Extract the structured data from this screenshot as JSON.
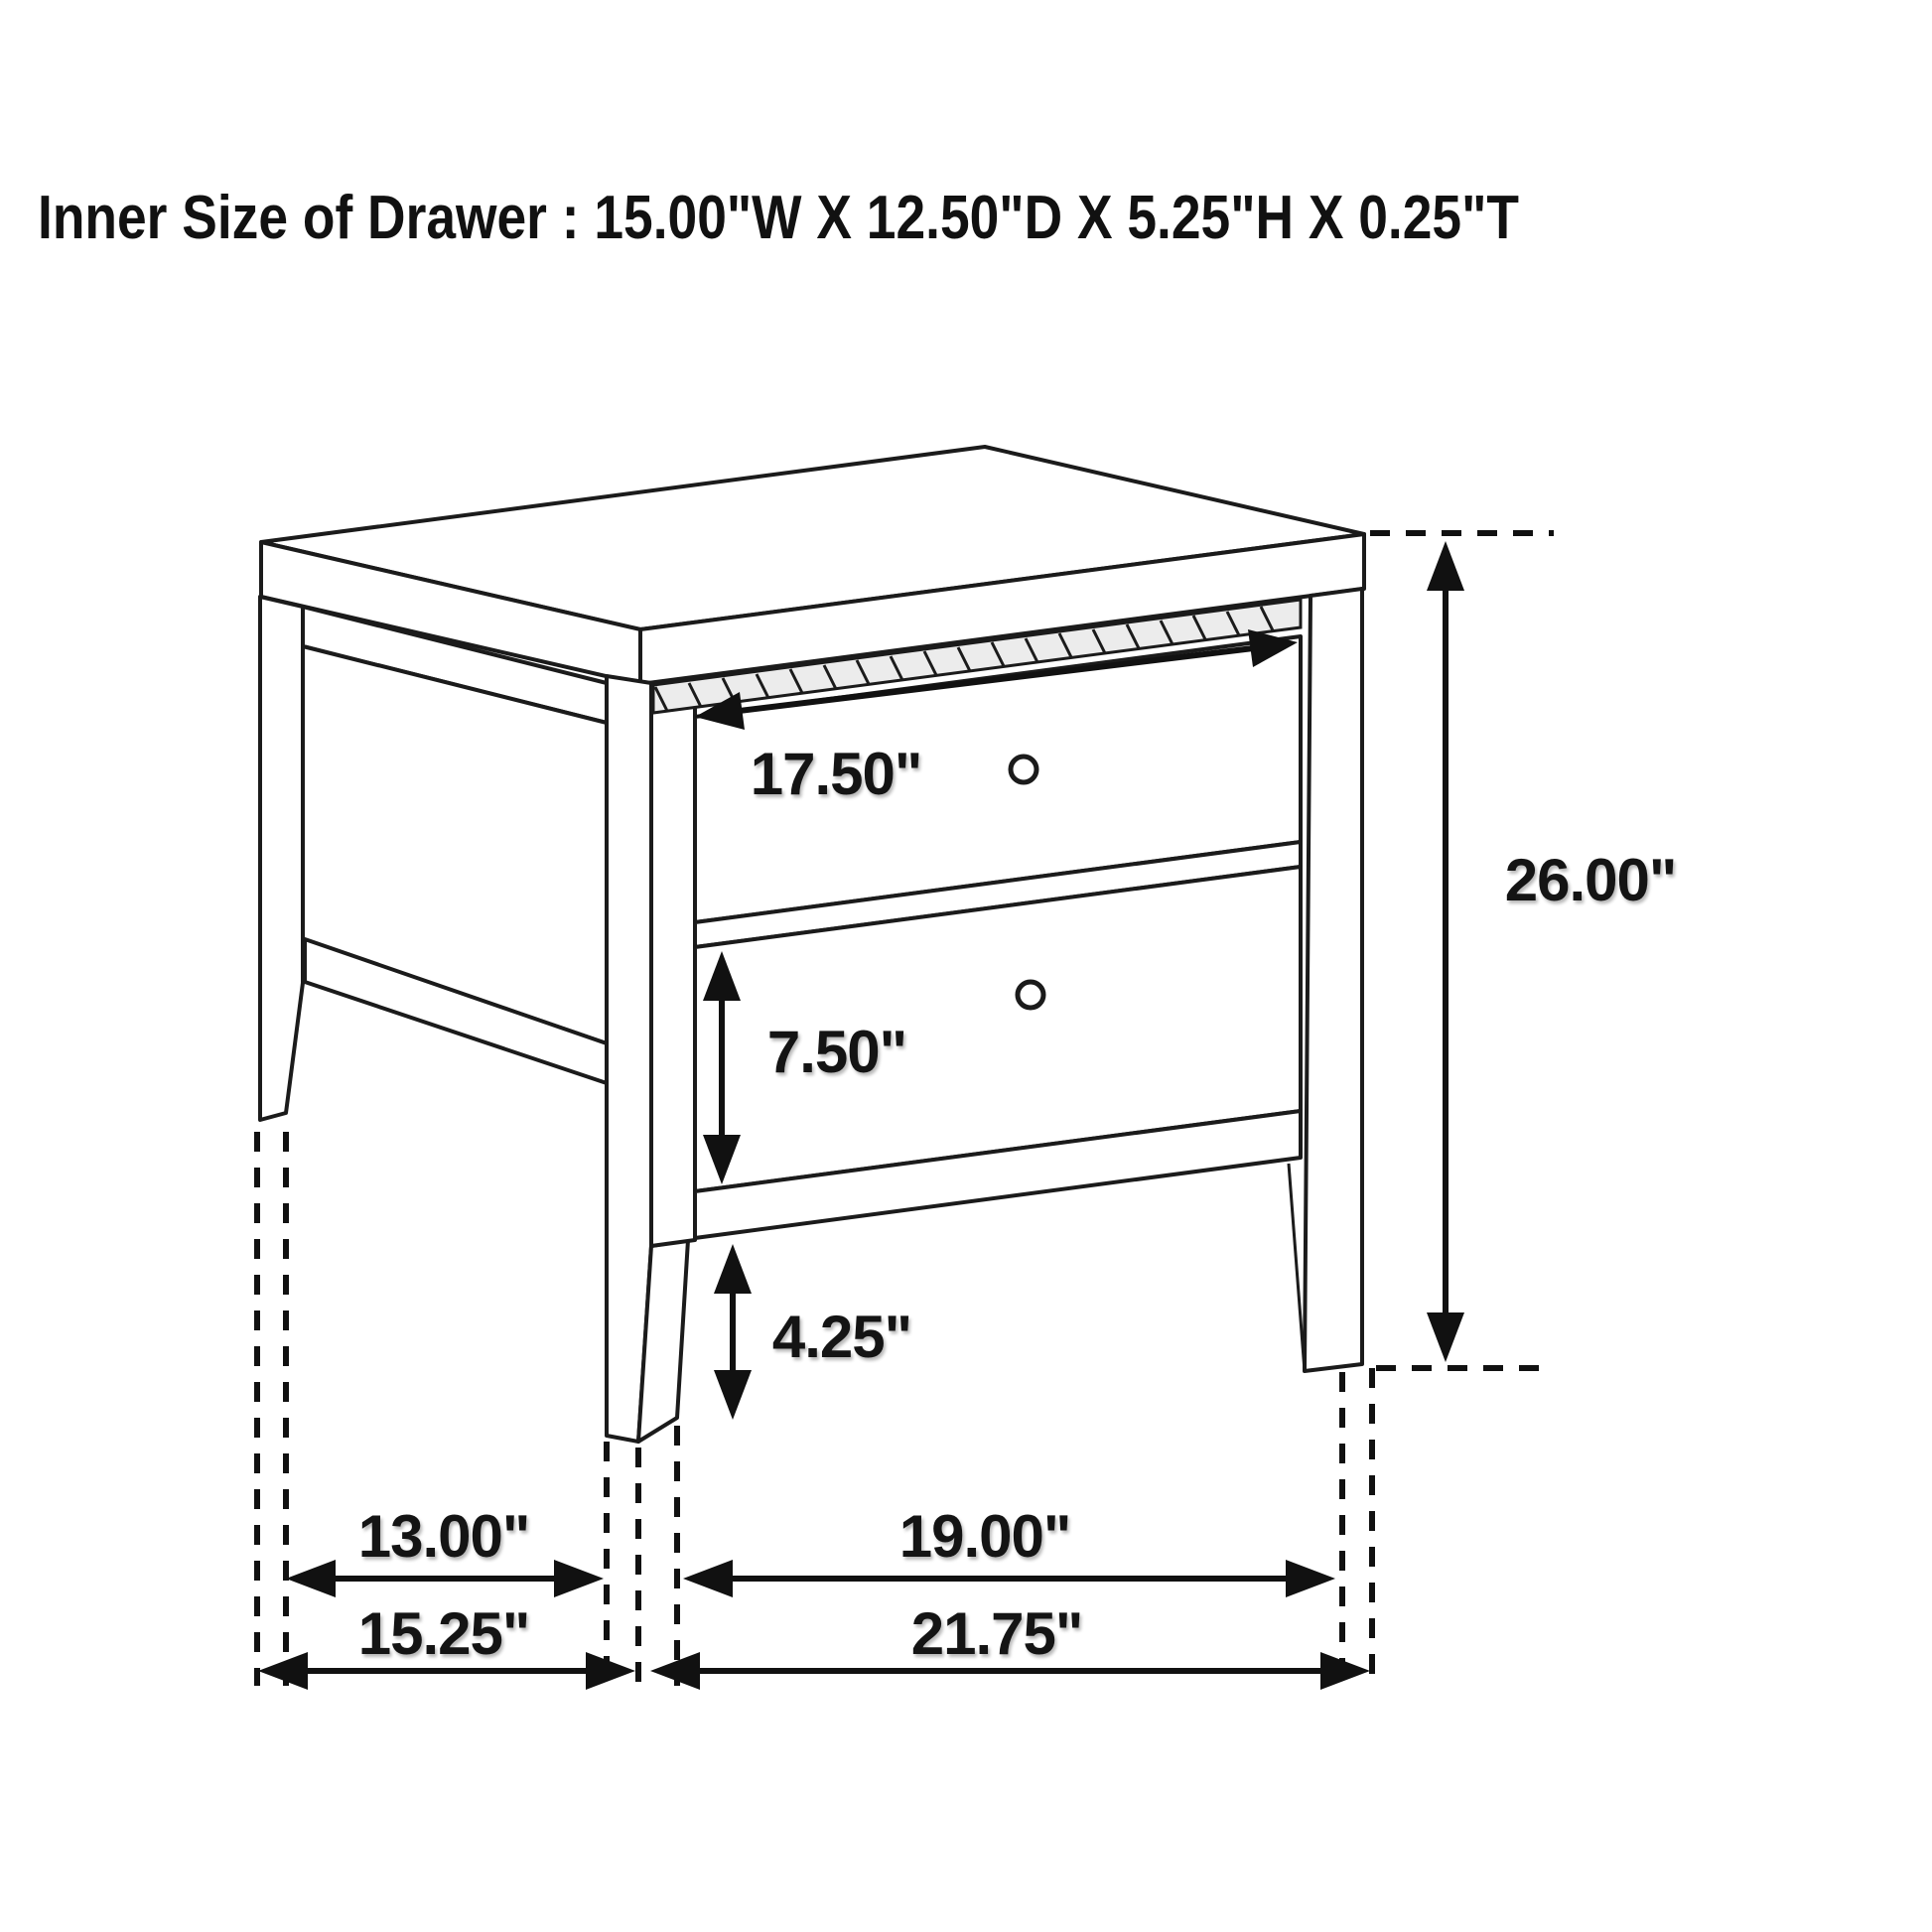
{
  "title": "Inner Size of Drawer : 15.00\"W X 12.50\"D X 5.25\"H X 0.25\"T",
  "object": "two-drawer nightstand dimension diagram",
  "labels": {
    "drawer_front_width": "17.50\"",
    "overall_height": "26.00\"",
    "bottom_drawer_height": "7.50\"",
    "floor_clearance": "4.25\"",
    "side_leg_spacing": "13.00\"",
    "front_leg_spacing": "19.00\"",
    "overall_depth": "15.25\"",
    "overall_width": "21.75\""
  },
  "inner_drawer_size": {
    "width": "15.00\"",
    "depth": "12.50\"",
    "height": "5.25\"",
    "thickness": "0.25\""
  },
  "colors": {
    "line": "#1b1b1b",
    "background": "#ffffff",
    "rope_fill": "#ececec"
  }
}
